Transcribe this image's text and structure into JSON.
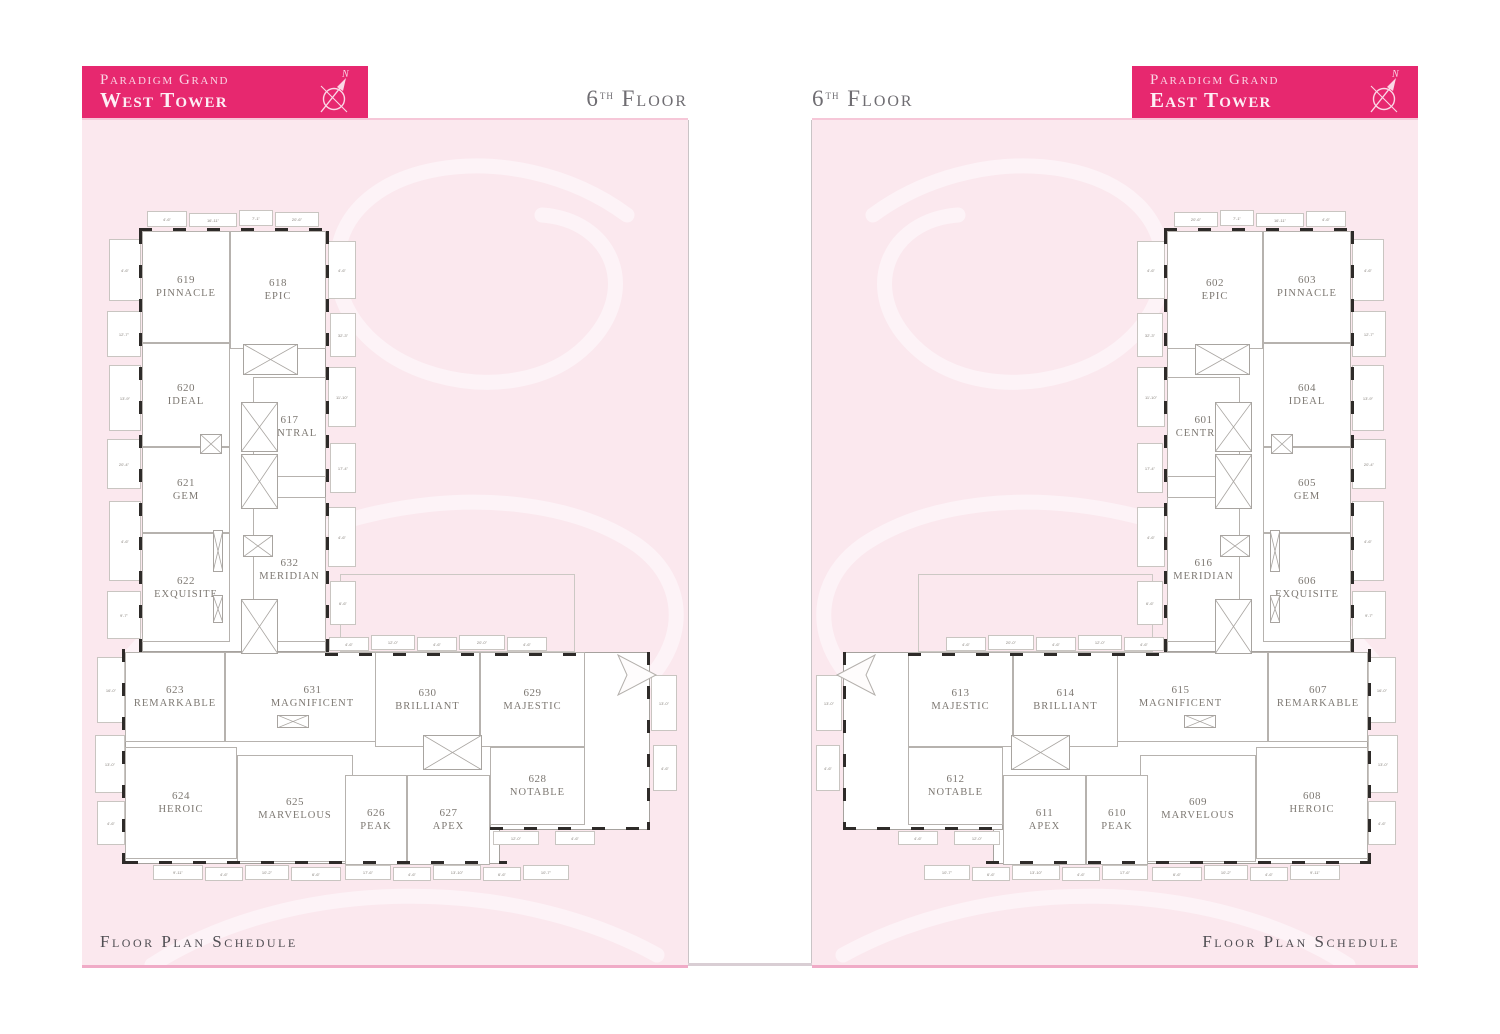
{
  "shared": {
    "brand": "Paradigm Grand",
    "floor_num": "6",
    "floor_sup": "th",
    "floor_word": "Floor",
    "schedule_label": "Floor Plan Schedule",
    "compass_letter": "N"
  },
  "colors": {
    "header_bg": "#e7286f",
    "header_text": "#fbd7e6",
    "panel_bg": "#fbe8ee",
    "panel_top_line": "#f6c7d8",
    "panel_bottom_rule": "#f0abc7",
    "floor_label_text": "#6f6d72",
    "schedule_text": "#504e53",
    "plan_text": "#7d7872",
    "wall_dark": "#2e2b29",
    "watermark": "#fdf3f7"
  },
  "towers": {
    "west": {
      "tower_name": "West Tower",
      "rooms": [
        {
          "number": "619",
          "name": "PINNACLE"
        },
        {
          "number": "618",
          "name": "EPIC"
        },
        {
          "number": "620",
          "name": "IDEAL"
        },
        {
          "number": "617",
          "name": "CENTRAL"
        },
        {
          "number": "621",
          "name": "GEM"
        },
        {
          "number": "622",
          "name": "EXQUISITE"
        },
        {
          "number": "632",
          "name": "MERIDIAN"
        },
        {
          "number": "623",
          "name": "REMARKABLE"
        },
        {
          "number": "631",
          "name": "MAGNIFICENT"
        },
        {
          "number": "630",
          "name": "BRILLIANT"
        },
        {
          "number": "629",
          "name": "MAJESTIC"
        },
        {
          "number": "624",
          "name": "HEROIC"
        },
        {
          "number": "625",
          "name": "MARVELOUS"
        },
        {
          "number": "626",
          "name": "PEAK"
        },
        {
          "number": "627",
          "name": "APEX"
        },
        {
          "number": "628",
          "name": "NOTABLE"
        }
      ]
    },
    "east": {
      "tower_name": "East Tower",
      "rooms": [
        {
          "number": "603",
          "name": "PINNACLE"
        },
        {
          "number": "602",
          "name": "EPIC"
        },
        {
          "number": "604",
          "name": "IDEAL"
        },
        {
          "number": "601",
          "name": "CENTRAL"
        },
        {
          "number": "605",
          "name": "GEM"
        },
        {
          "number": "606",
          "name": "EXQUISITE"
        },
        {
          "number": "616",
          "name": "MERIDIAN"
        },
        {
          "number": "607",
          "name": "REMARKABLE"
        },
        {
          "number": "615",
          "name": "MAGNIFICENT"
        },
        {
          "number": "614",
          "name": "BRILLIANT"
        },
        {
          "number": "613",
          "name": "MAJESTIC"
        },
        {
          "number": "608",
          "name": "HEROIC"
        },
        {
          "number": "609",
          "name": "MARVELOUS"
        },
        {
          "number": "610",
          "name": "PEAK"
        },
        {
          "number": "611",
          "name": "APEX"
        },
        {
          "number": "612",
          "name": "NOTABLE"
        }
      ]
    }
  },
  "geometry": {
    "plan": {
      "w": 565,
      "h": 675
    },
    "room_rects": [
      [
        47,
        24,
        88,
        112
      ],
      [
        135,
        24,
        96,
        118
      ],
      [
        47,
        136,
        88,
        104
      ],
      [
        158,
        170,
        73,
        100
      ],
      [
        47,
        240,
        88,
        86
      ],
      [
        47,
        326,
        88,
        109
      ],
      [
        158,
        290,
        73,
        145
      ],
      [
        30,
        445,
        100,
        90
      ],
      [
        130,
        445,
        175,
        90
      ],
      [
        280,
        445,
        105,
        95
      ],
      [
        385,
        445,
        105,
        95
      ],
      [
        30,
        540,
        112,
        112
      ],
      [
        142,
        548,
        116,
        107
      ],
      [
        250,
        568,
        62,
        90
      ],
      [
        312,
        568,
        83,
        90
      ],
      [
        395,
        540,
        95,
        78
      ]
    ],
    "underlays": [
      [
        47,
        24,
        184,
        421
      ],
      [
        30,
        445,
        375,
        212
      ],
      [
        395,
        445,
        160,
        178
      ]
    ],
    "terraces": [
      [
        245,
        367,
        235,
        78
      ]
    ],
    "walls": [
      [
        44,
        21,
        190,
        3,
        "h"
      ],
      [
        44,
        24,
        3,
        424,
        "v"
      ],
      [
        231,
        24,
        3,
        421,
        "v"
      ],
      [
        27,
        442,
        3,
        215,
        "v"
      ],
      [
        30,
        654,
        382,
        3,
        "h"
      ],
      [
        395,
        620,
        160,
        3,
        "h"
      ],
      [
        552,
        445,
        3,
        178,
        "v"
      ],
      [
        230,
        446,
        260,
        3,
        "h"
      ]
    ],
    "shafts": [
      [
        148,
        137,
        55,
        31
      ],
      [
        146,
        195,
        37,
        50
      ],
      [
        146,
        247,
        37,
        55
      ],
      [
        105,
        227,
        22,
        20
      ],
      [
        148,
        328,
        30,
        22
      ],
      [
        146,
        392,
        37,
        55
      ],
      [
        118,
        323,
        10,
        42
      ],
      [
        118,
        388,
        10,
        28
      ],
      [
        182,
        508,
        32,
        13
      ],
      [
        328,
        528,
        59,
        35
      ]
    ],
    "bays": [
      [
        52,
        4,
        40,
        16,
        "4'-6\""
      ],
      [
        94,
        6,
        48,
        14,
        "16'-11\""
      ],
      [
        144,
        3,
        34,
        16,
        "7'-1\""
      ],
      [
        180,
        5,
        44,
        15,
        "20'-6\""
      ],
      [
        233,
        34,
        28,
        58,
        "4'-6\""
      ],
      [
        235,
        106,
        26,
        44,
        "32'-3\""
      ],
      [
        233,
        160,
        28,
        60,
        "11'-10\""
      ],
      [
        235,
        236,
        26,
        50,
        "17'-4\""
      ],
      [
        233,
        300,
        28,
        60,
        "4'-6\""
      ],
      [
        235,
        374,
        26,
        44,
        "6'-6\""
      ],
      [
        14,
        32,
        32,
        62,
        "4'-6\""
      ],
      [
        12,
        104,
        34,
        46,
        "12'-7\""
      ],
      [
        14,
        158,
        32,
        66,
        "13'-9\""
      ],
      [
        12,
        232,
        34,
        50,
        "20'-4\""
      ],
      [
        14,
        294,
        32,
        80,
        "4'-6\""
      ],
      [
        12,
        384,
        34,
        48,
        "9'-7\""
      ],
      [
        2,
        450,
        28,
        66,
        "16'-0\""
      ],
      [
        0,
        528,
        30,
        58,
        "13'-0\""
      ],
      [
        2,
        594,
        28,
        44,
        "4'-6\""
      ],
      [
        58,
        658,
        50,
        15,
        "9'-11\""
      ],
      [
        110,
        660,
        38,
        14,
        "4'-6\""
      ],
      [
        150,
        658,
        44,
        15,
        "10'-2\""
      ],
      [
        196,
        660,
        50,
        14,
        "6'-6\""
      ],
      [
        250,
        658,
        46,
        15,
        "17'-6\""
      ],
      [
        298,
        660,
        38,
        14,
        "4'-6\""
      ],
      [
        338,
        658,
        48,
        15,
        "13'-10\""
      ],
      [
        388,
        660,
        38,
        14,
        "6'-6\""
      ],
      [
        428,
        658,
        46,
        15,
        "10'-7\""
      ],
      [
        398,
        624,
        46,
        14,
        "12'-0\""
      ],
      [
        460,
        624,
        40,
        14,
        "4'-6\""
      ],
      [
        556,
        468,
        26,
        56,
        "13'-0\""
      ],
      [
        558,
        538,
        24,
        46,
        "4'-6\""
      ],
      [
        234,
        430,
        40,
        14,
        "4'-6\""
      ],
      [
        276,
        428,
        44,
        15,
        "12'-0\""
      ],
      [
        322,
        430,
        40,
        14,
        "4'-6\""
      ],
      [
        364,
        428,
        46,
        15,
        "20'-0\""
      ],
      [
        412,
        430,
        40,
        14,
        "4'-6\""
      ]
    ],
    "arrow": [
      521,
      446,
      42,
      44
    ]
  }
}
